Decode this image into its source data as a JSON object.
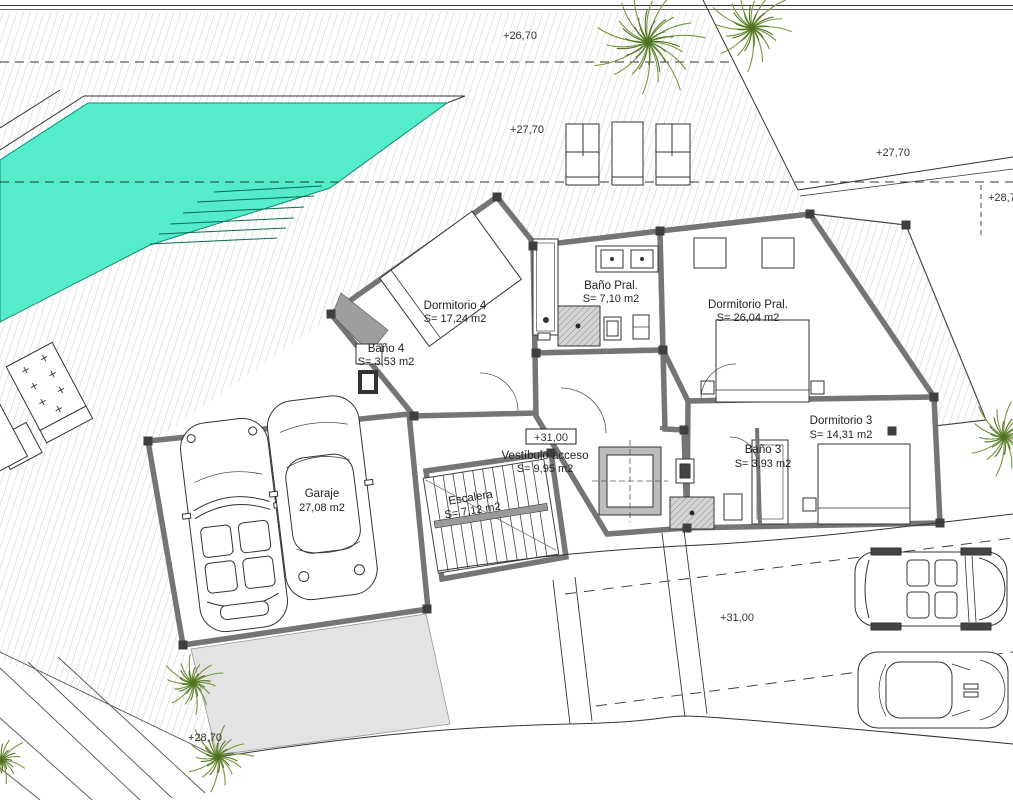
{
  "drawing": {
    "kind": "architectural-floor-plan",
    "description": "Villa upper floor plan with pool, deck, garage and street"
  },
  "levels": {
    "top_boundary": "+26,70",
    "pool_deck": "+27,70",
    "upper_right": "+27,70",
    "right_edge": "+28,7",
    "entry_boxed": "+31,00",
    "street": "+31,00",
    "lower_left": "+28,70"
  },
  "rooms": {
    "dormitorio_4": {
      "name": "Dormitorio 4",
      "area": "S= 17,24 m2"
    },
    "bano_4": {
      "name": "Baño 4",
      "area": "S= 3,53 m2"
    },
    "bano_pral": {
      "name": "Baño Pral.",
      "area": "S= 7,10 m2"
    },
    "dormitorio_pral": {
      "name": "Dormitorio Pral.",
      "area": "S= 26,04 m2"
    },
    "dormitorio_3": {
      "name": "Dormitorio 3",
      "area": "S= 14,31 m2"
    },
    "bano_3": {
      "name": "Baño 3",
      "area": "S= 3,93 m2"
    },
    "vestibulo": {
      "name": "Vestíbulo acceso",
      "area": "S= 9,95 m2"
    },
    "escalera": {
      "name": "Escalera",
      "area": "S= 7,12 m2"
    },
    "garaje": {
      "name": "Garaje",
      "area": "27,08 m2"
    }
  },
  "colors": {
    "pool": "#55ecc9",
    "pool_edge": "#0a8f78",
    "wall": "#757575",
    "hatch": "#c9c9c9",
    "driveway": "#e3e3e3",
    "plant": "#74973a",
    "plant_dark": "#4e7226"
  }
}
